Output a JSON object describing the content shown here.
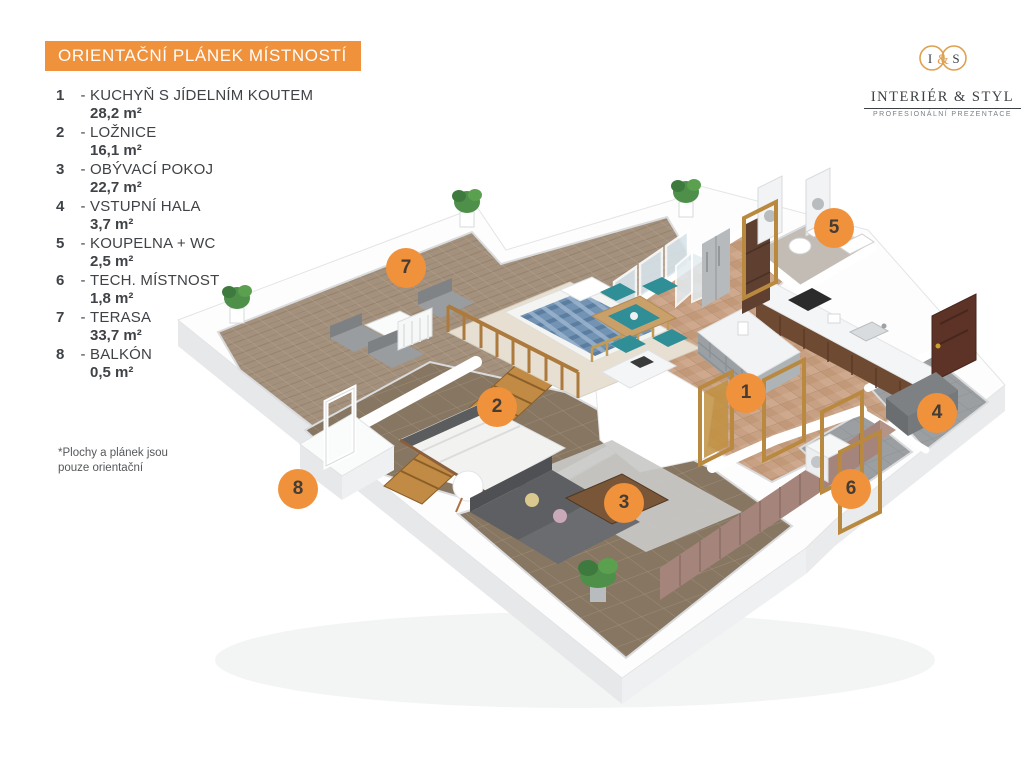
{
  "header": {
    "title": "ORIENTAČNÍ PLÁNEK MÍSTNOSTÍ"
  },
  "logo": {
    "monogram_left": "I",
    "monogram_amp": "&",
    "monogram_right": "S",
    "name": "INTERIÉR & STYL",
    "tagline": "PROFESIONÁLNÍ PREZENTACE"
  },
  "legend": {
    "separator": "-",
    "rooms": [
      {
        "number": "1",
        "name": "KUCHYŇ S JÍDELNÍM KOUTEM",
        "area": "28,2 m²"
      },
      {
        "number": "2",
        "name": "LOŽNICE",
        "area": "16,1 m²"
      },
      {
        "number": "3",
        "name": "OBÝVACÍ POKOJ",
        "area": "22,7 m²"
      },
      {
        "number": "4",
        "name": "VSTUPNÍ HALA",
        "area": "3,7 m²"
      },
      {
        "number": "5",
        "name": "KOUPELNA + WC",
        "area": "2,5 m²"
      },
      {
        "number": "6",
        "name": "TECH. MÍSTNOST",
        "area": "1,8 m²"
      },
      {
        "number": "7",
        "name": "TERASA",
        "area": "33,7 m²"
      },
      {
        "number": "8",
        "name": "BALKÓN",
        "area": "0,5 m²"
      }
    ]
  },
  "note": {
    "line1": "*Plochy  a plánek jsou",
    "line2": "pouze orientační"
  },
  "colors": {
    "accent_orange": "#f0913c",
    "ink": "#3f4246",
    "terrace_floor": "#a4917d",
    "kitchen_floor": "#c8a184",
    "dark_floor": "#877661",
    "entry_floor": "#9b9fa2",
    "wall_white": "#ffffff",
    "wood_stairs": "#c18b45",
    "door_frame_gold": "#b9893f",
    "entry_door_brown": "#5c3326",
    "teal_chairs": "#2f8e96",
    "bed_plaid_blue": "#7293b4"
  }
}
